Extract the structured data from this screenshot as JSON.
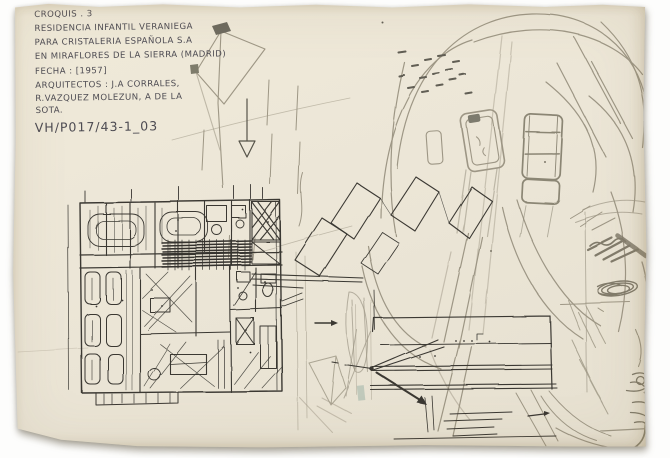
{
  "annotation": {
    "lines": [
      "CROQUIS . 3",
      "RESIDENCIA INFANTIL VERANIEGA",
      "PARA CRISTALERIA ESPAÑOLA S.A",
      "EN MIRAFLORES DE LA SIERRA (MADRID)",
      "FECHA : [1957]",
      "ARQUITECTOS : J.A CORRALES,",
      "R.VAZQUEZ MOLEZUN, A DE LA",
      "SOTA."
    ],
    "reference": "VH/P017/43-1_03"
  },
  "palette": {
    "background": "#ffffff",
    "paper": "#ece6d7",
    "ink": "#3a3833",
    "text_ink": "#4d4b52",
    "pencil": "#8f8876",
    "graphite_dark": "#57534a",
    "accent_teal": "#7fa095"
  }
}
